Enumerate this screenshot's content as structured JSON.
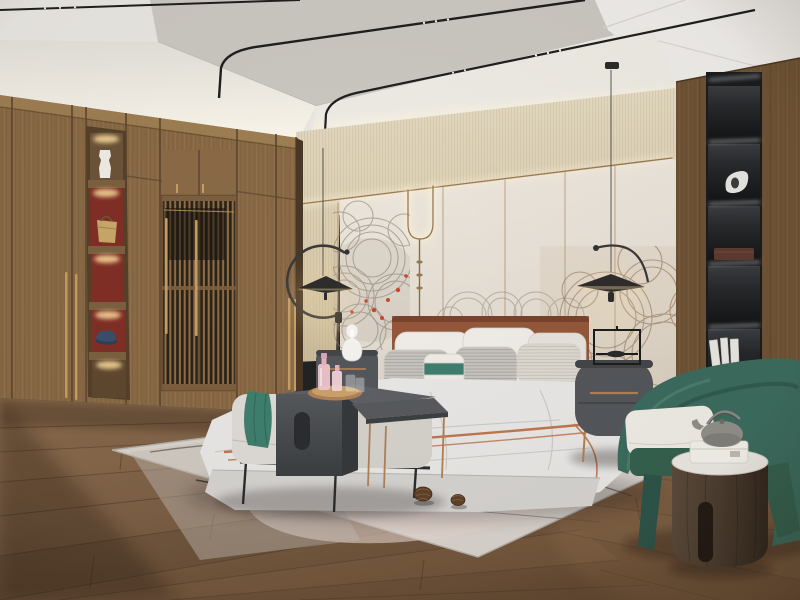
{
  "scene": {
    "description": "3D render of a modern Chinese-style (Japandi) bedroom: wooden wardrobe with lattice doors and lit display niches on the left, beige accent wall with wave-line mural and cove lighting behind an upholstered bed, two saucer pendant lamps, black display shelving set in a wood column on the right, a green barrel armchair with a round wooden tea table, bench and dark side tables at the foot of the bed, a pale rug with pine cones on a diagonal plank wood floor."
  },
  "palette": {
    "ceiling_light": "#e9e7e2",
    "ceiling_tray": "#cbc7c1",
    "ceiling_white": "#efedea",
    "wall_beige": "#d9cdb4",
    "wall_beige_dark": "#c4b596",
    "wall_panel": "#e8e2d8",
    "wall_panel_dark": "#d8d0c3",
    "trim_bronze": "#9a7a50",
    "glow_warm": "#ffdf9f",
    "mural_gray": "#867c73",
    "mural_brown": "#8a6a48",
    "mural_red": "#c6492f",
    "wardrobe_wood": "#8a6a46",
    "wardrobe_dark": "#6b5134",
    "wardrobe_light": "#a08154",
    "niche_red": "#802f26",
    "lattice_dark": "#2c2317",
    "brass": "#c59e62",
    "right_wood": "#6f5335",
    "shelf_black": "#191b1d",
    "shelf_panel": "#2a2d30",
    "floor_mid": "#7e6147",
    "floor_dark": "#5a422e",
    "floor_light": "#9a7b59",
    "rug_base": "#d9d3cd",
    "rug_pink": "#e4d6ce",
    "bed_duvet": "#e8e7e5",
    "bed_base": "#d5d3d0",
    "headboard": "#94573a",
    "headboard_dark": "#7c4530",
    "pillow_white": "#f0ede8",
    "pillow_gray": "#c7c4bf",
    "pillow_cream": "#ded9d1",
    "teal": "#3f7e6d",
    "blanket_orange": "#bf7750",
    "bench": "#dedbd6",
    "table_dark": "#46494d",
    "table_mid": "#575a5e",
    "copper": "#b18055",
    "nightstand": "#53565a",
    "lamp_white": "#f5f3ef",
    "chair_green": "#3b6b5e",
    "chair_green_dark": "#2c5348",
    "cushion_white": "#efece5",
    "tea_table_wood": "#4a3c2f",
    "marble": "#eae7e1",
    "teapot_gray": "#908e89",
    "box_white": "#f2f0ea",
    "pendant_black": "#2e2d2b",
    "cable_dark": "#3c3b3a"
  },
  "objects": [
    {
      "name": "ceiling-track-lights",
      "note": "black magnetic rails with tiny spots, bending down the wall"
    },
    {
      "name": "pendant-lamp-left",
      "note": "flat saucer shade with C-ring arm, warm lit rim"
    },
    {
      "name": "pendant-lamp-right",
      "note": "flat saucer shade with arc arm on thin cable"
    },
    {
      "name": "wardrobe",
      "note": "full-height wood wardrobe with lattice doors and brass pulls"
    },
    {
      "name": "display-niches",
      "note": "lit niches with white vase, tan handbag, blue cap, red backs"
    },
    {
      "name": "accent-wall",
      "note": "beige textured band over cream panels with bronze trim and LED cove"
    },
    {
      "name": "wave-mural",
      "note": "concentric fan/wave line art with red blossom accents"
    },
    {
      "name": "bed",
      "note": "leather channel headboard, white bedding, terracotta trim blanket"
    },
    {
      "name": "nightstands",
      "note": "dark grey rounded cabinets, copper pulls, gourd lamp and frame lamp"
    },
    {
      "name": "bench-and-tables",
      "note": "white bench, teal throw, dark grey slab and slim side tables, perfume tray"
    },
    {
      "name": "rug",
      "note": "pale rug with curved branch pattern and two pine cones"
    },
    {
      "name": "shelf-unit",
      "note": "black lit niches in wood column: sculpture, wooden box, white books"
    },
    {
      "name": "armchair",
      "note": "green barrel chair with white seat cushion"
    },
    {
      "name": "tea-table",
      "note": "round wood cylinder table, marble top, teapot and white box"
    },
    {
      "name": "wood-floor",
      "note": "diagonal plank oak floor, darker toward lower left"
    }
  ]
}
